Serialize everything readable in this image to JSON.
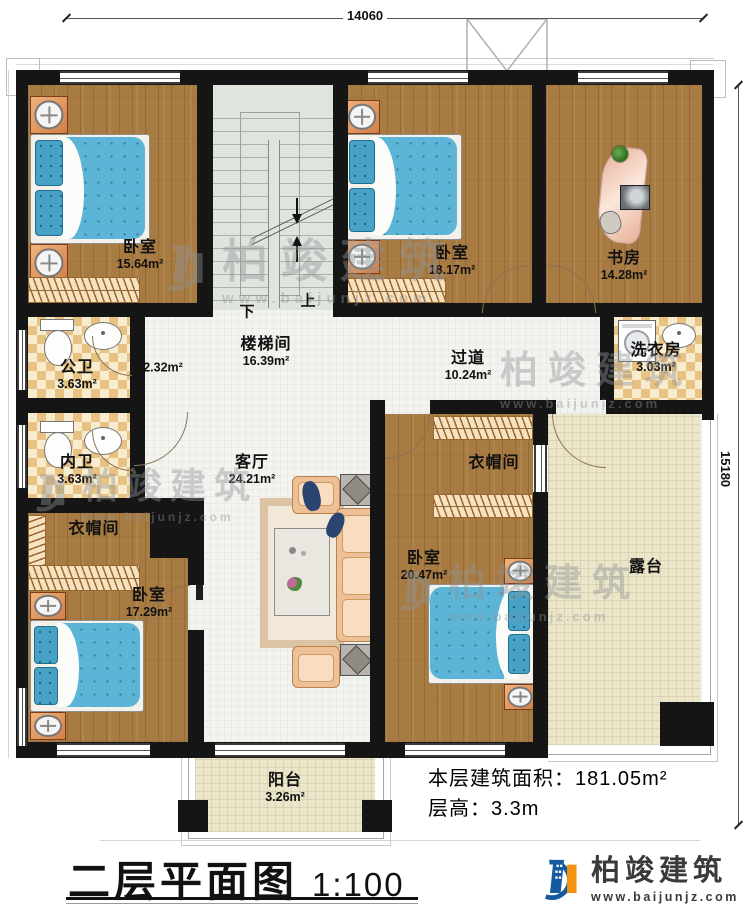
{
  "dimensions": {
    "width": "14060",
    "height": "15180"
  },
  "rooms": {
    "bedroom_tl": {
      "name": "卧室",
      "area": "15.64m²"
    },
    "stairwell": {
      "name": "楼梯间",
      "area": "16.39m²"
    },
    "bedroom_tm": {
      "name": "卧室",
      "area": "18.17m²"
    },
    "study": {
      "name": "书房",
      "area": "14.28m²"
    },
    "public_bath": {
      "name": "公卫",
      "area": "3.63m²"
    },
    "lobby": {
      "area": "2.32m²"
    },
    "corridor": {
      "name": "过道",
      "area": "10.24m²"
    },
    "laundry": {
      "name": "洗衣房",
      "area": "3.03m²"
    },
    "private_bath": {
      "name": "内卫",
      "area": "3.63m²"
    },
    "cloakroom_left": {
      "name": "衣帽间"
    },
    "living": {
      "name": "客厅",
      "area": "24.21m²"
    },
    "cloakroom_right": {
      "name": "衣帽间"
    },
    "bedroom_br": {
      "name": "卧室",
      "area": "20.47m²"
    },
    "terrace": {
      "name": "露台"
    },
    "bedroom_bl": {
      "name": "卧室",
      "area": "17.29m²"
    },
    "balcony": {
      "name": "阳台",
      "area": "3.26m²"
    }
  },
  "stairs": {
    "up": "上",
    "down": "下"
  },
  "info": {
    "floor_area_label": "本层建筑面积：",
    "floor_area_value": "181.05m²",
    "floor_height_label": "层高：",
    "floor_height_value": "3.3m"
  },
  "title": {
    "text": "二层平面图",
    "scale": "1:100"
  },
  "brand": {
    "name": "柏竣建筑",
    "url": "www.baijunjz.com"
  },
  "watermark": {
    "name": "柏竣建筑",
    "url": "www.baijunjz.com"
  },
  "colors": {
    "wall": "#151515",
    "wood": "#a87b42",
    "tile": "#e8c283",
    "stair": "#dfe5dd",
    "terrace": "#ebe5c9",
    "bed": "#5cb5d7",
    "logo_blue": "#155a9e",
    "logo_orange": "#f4930f"
  }
}
